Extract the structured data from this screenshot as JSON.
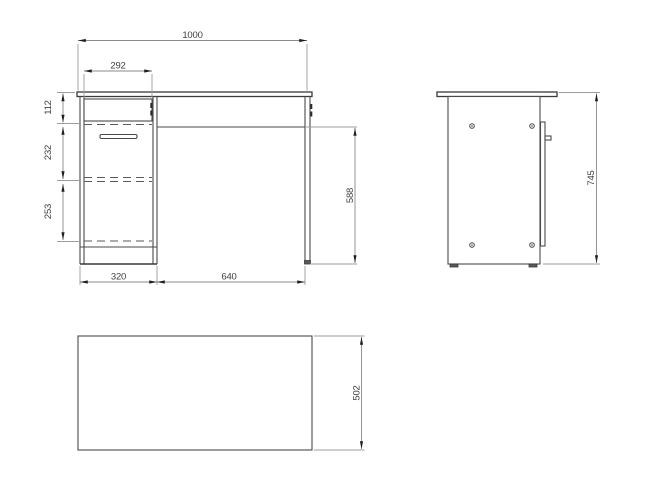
{
  "palette": {
    "background": "#ffffff",
    "object_line": "#4a4a4a",
    "dimension_line": "#8a8a8a",
    "text": "#3f3f3f"
  },
  "front_view": {
    "overall_width": "1000",
    "drawer_width": "292",
    "drawer_height": "112",
    "upper_door_section": "232",
    "lower_door_section": "253",
    "pedestal_width": "320",
    "opening_width": "640",
    "side_height": "588"
  },
  "side_view": {
    "overall_height": "745"
  },
  "top_view": {
    "depth": "502"
  }
}
